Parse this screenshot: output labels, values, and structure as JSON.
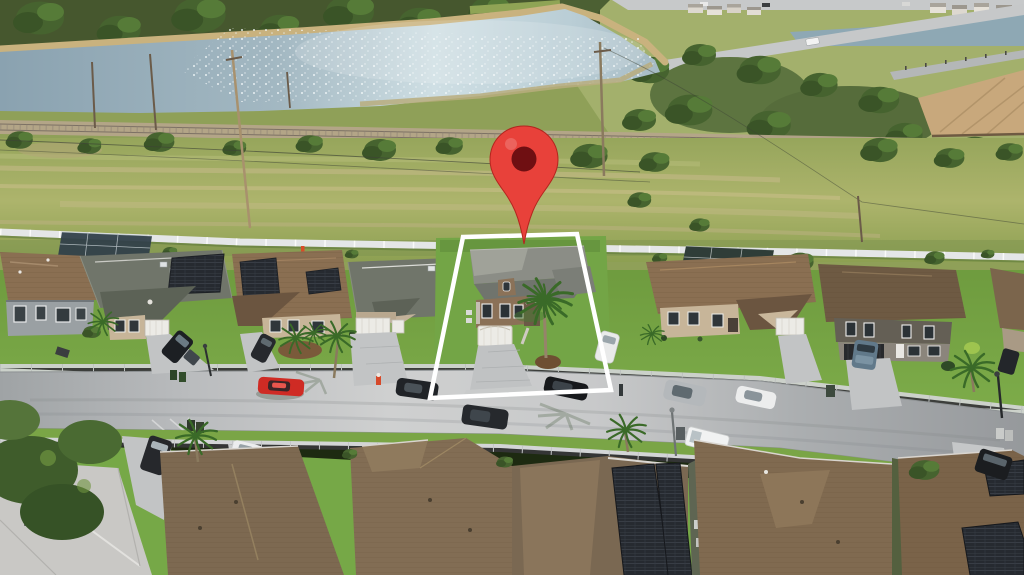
{
  "image": {
    "kind": "aerial real-estate drone photo",
    "subject": "suburban single-family neighborhood beside a retention lake",
    "marker_present": true,
    "highlighted_lot_present": true
  },
  "overlay": {
    "pin": {
      "fill": "#e8413a",
      "hole": "#6f0f12",
      "edge": "#b3261f"
    },
    "boundary": {
      "stroke": "#ffffff",
      "width": 4.5
    }
  },
  "palette": {
    "treeline": "#46572e",
    "tree": "#4a6630",
    "field": "#a4ae67",
    "field_streak": "#c6ba8a",
    "lake_left": "#8aa2b0",
    "lake_bright": "#cfdfe4",
    "bank": "#c9b27e",
    "marsh": "#b9ad7e",
    "rail": "#b5a58a",
    "canal": "#8ea8b4",
    "road": "#c6c8c9",
    "building": "#c8a87c",
    "fence": "#e4e6e7",
    "backyard_lawn": "#7aa04b",
    "lawn": "#74a544",
    "lawn_bright": "#7fae4b",
    "street": "#b6b9bb",
    "sidewalk": "#d3d5d6",
    "concrete": "#c2c4c5",
    "roof_gray_green": "#70756a",
    "roof_brown": "#8a6f52",
    "roof_dark_brown": "#6e5a43",
    "roof_featured": "#8b8d86",
    "roof_fg": "#7d6951",
    "roof_fg_light": "#c9c8c5",
    "facade_tan": "#c7b599",
    "facade_gray": "#9aa0a3",
    "facade_dark": "#645f55",
    "facade_featured": "#8b7157",
    "garage_white": "#ecebe6",
    "garage_dark": "#27292c",
    "solar": "#262a30",
    "pool_screen": "#31404a",
    "palm": "#3a6a28",
    "mulch": "#6e4f32"
  },
  "vehicles": {
    "red_car": "#cf2b24",
    "dark_sedan": "#202327",
    "street_suv": "#26292d",
    "silver_suv": "#b4b8bb",
    "white_car": "#eceded",
    "white_van": "#f1f2f2",
    "white_suv": "#e9eaea",
    "steel_blue_car": "#61798a",
    "driveway_suv_a": "#1c1f23",
    "driveway_suv_b": "#26292d",
    "dark_van": "#26282c",
    "fg_white_car": "#ecedee",
    "fg_dark_car": "#1b1d20",
    "pickup_dark": "#23262a",
    "distant_white_car": "#f2f2f2"
  }
}
